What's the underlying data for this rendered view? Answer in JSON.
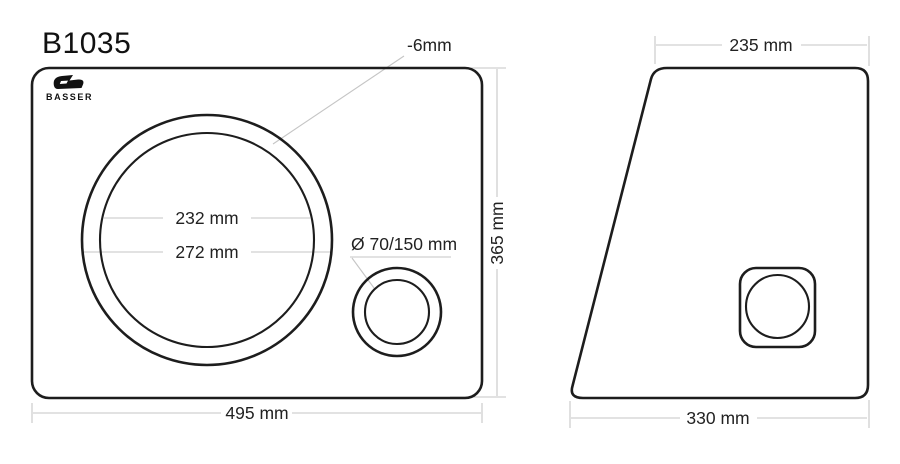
{
  "title": "B1035",
  "brand": {
    "name": "BASSER"
  },
  "colors": {
    "outline": "#1d1d1d",
    "dimension_line": "#c5c5c5",
    "text": "#222222",
    "background": "#ffffff"
  },
  "front_view": {
    "width_label": "495 mm",
    "height_label": "365 mm",
    "speaker_cutout": {
      "inner_diameter_label": "232 mm",
      "outer_diameter_label": "272 mm",
      "recess_depth_label": "-6mm"
    },
    "port": {
      "diameter_label": "Ø 70/150 mm"
    }
  },
  "side_view": {
    "top_width_label": "235 mm",
    "bottom_width_label": "330 mm"
  }
}
